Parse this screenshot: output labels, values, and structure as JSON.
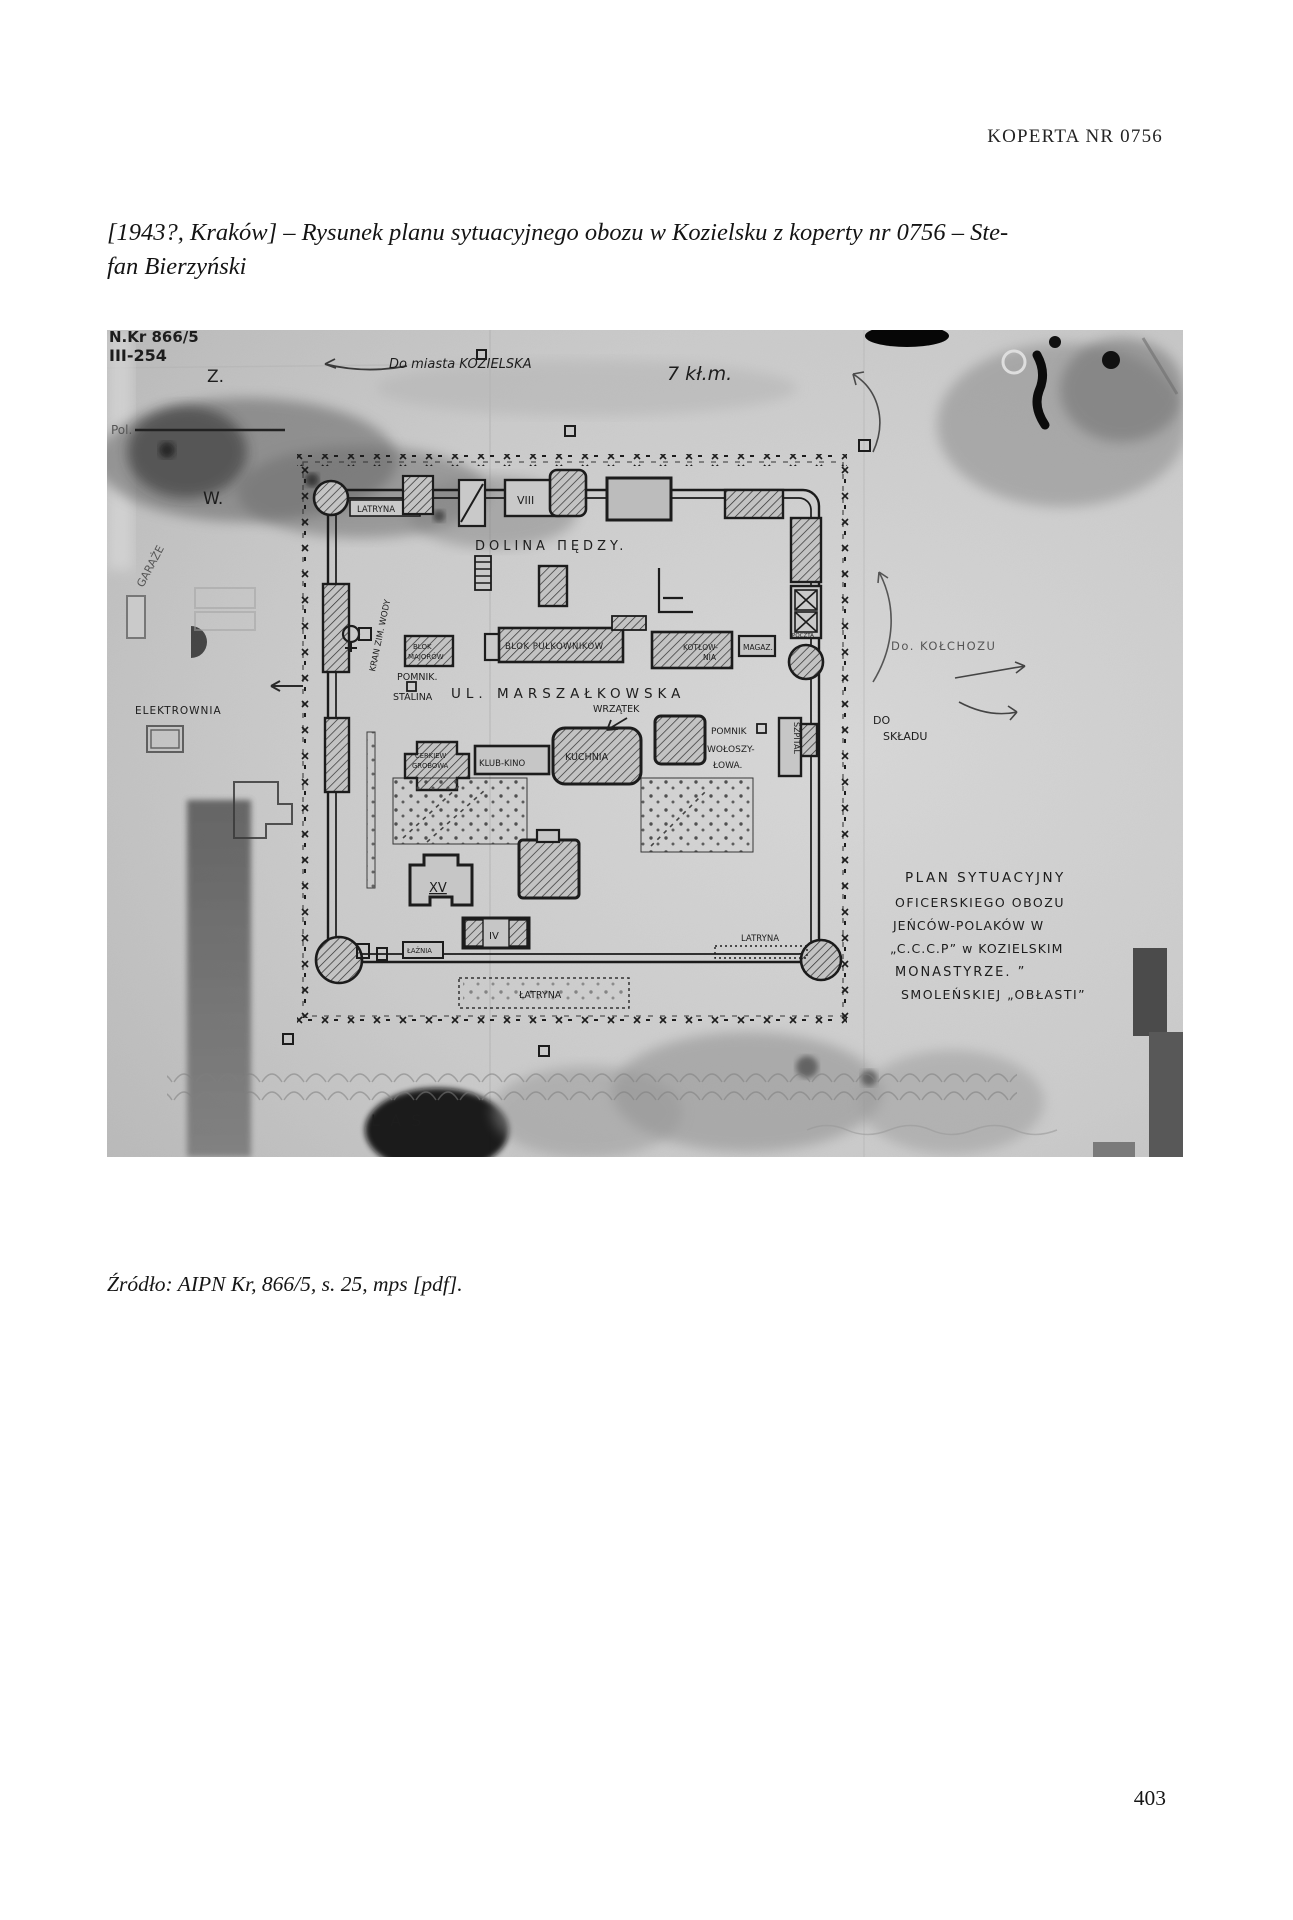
{
  "header": {
    "text": "KOPERTA NR 0756"
  },
  "caption": {
    "line1": "[1943?, Kraków] – Rysunek planu sytuacyjnego obozu w Kozielsku z koperty nr 0756 – Ste-",
    "line2": "fan Bierzyński"
  },
  "photo": {
    "stamp": {
      "line1": "N.Kr 866/5",
      "line2": "III-254"
    },
    "labels": {
      "z": "Z.",
      "pol": "Pol.",
      "w": "W.",
      "route_top": "Do miasta KOZIELSKA",
      "route_top_distance": "7 kł.m.",
      "garaze": "GARAŻE",
      "elektrownia": "ELEKTROWNIA",
      "latryna_top": "LATRYNA",
      "blok_viii": "VIII",
      "dolina": "DOLINA ΠĘDZY.",
      "kran": "KRAN ZIM. WODY",
      "blok_majorow_1": "BLOK",
      "blok_majorow_2": "MAJORÓW",
      "blok_pulkownikow": "BLOK PUŁKOWNIKÓW",
      "kotlownia_1": "KOTŁOW-",
      "kotlownia_2": "NIA",
      "magazyn": "MAGAZ.",
      "pomnik_stalina_1": "POMNIK.",
      "pomnik_stalina_2": "STALINA",
      "ulica": "UL. MARSZAŁKOWSKA",
      "wrzatek": "WRZĄTEK",
      "cerkiew_1": "CERKIEW",
      "cerkiew_2": "GROBOWA",
      "klub_kino": "KLUB-KINO",
      "kuchnia": "KUCHNIA",
      "pomnik_woloszylowa_1": "POMNIK",
      "pomnik_woloszylowa_2": "WOŁOSZY-",
      "pomnik_woloszylowa_3": "ŁOWA.",
      "szpital": "SZPITAL",
      "poczta": "POCZTA",
      "blok_xv": "XV",
      "blok_iv": "IV",
      "laznia": "ŁAŹNIA",
      "latryna_right": "LATRYNA",
      "latryna_bottom": "ŁATRYNA",
      "do_kolchozu": "Do. KOŁCHOZU",
      "do_skladu_1": "DO",
      "do_skladu_2": "SKŁADU",
      "plan_1": "PLAN  SYTUACYJNY",
      "plan_2": "OFICERSKIEGO OBOZU",
      "plan_3": "JEŃCÓW-POLAKÓW W",
      "plan_4": "„C.C.C.P” w KOZIELSKIM",
      "plan_5": "MONASTYRZE. ”",
      "plan_6": "SMOLEŃSKIEJ „OBŁASTI”",
      "las": "LAS"
    }
  },
  "source": {
    "text": "Źródło: AIPN Kr, 866/5, s. 25, mps [pdf]."
  },
  "footer": {
    "page_number": "403"
  }
}
